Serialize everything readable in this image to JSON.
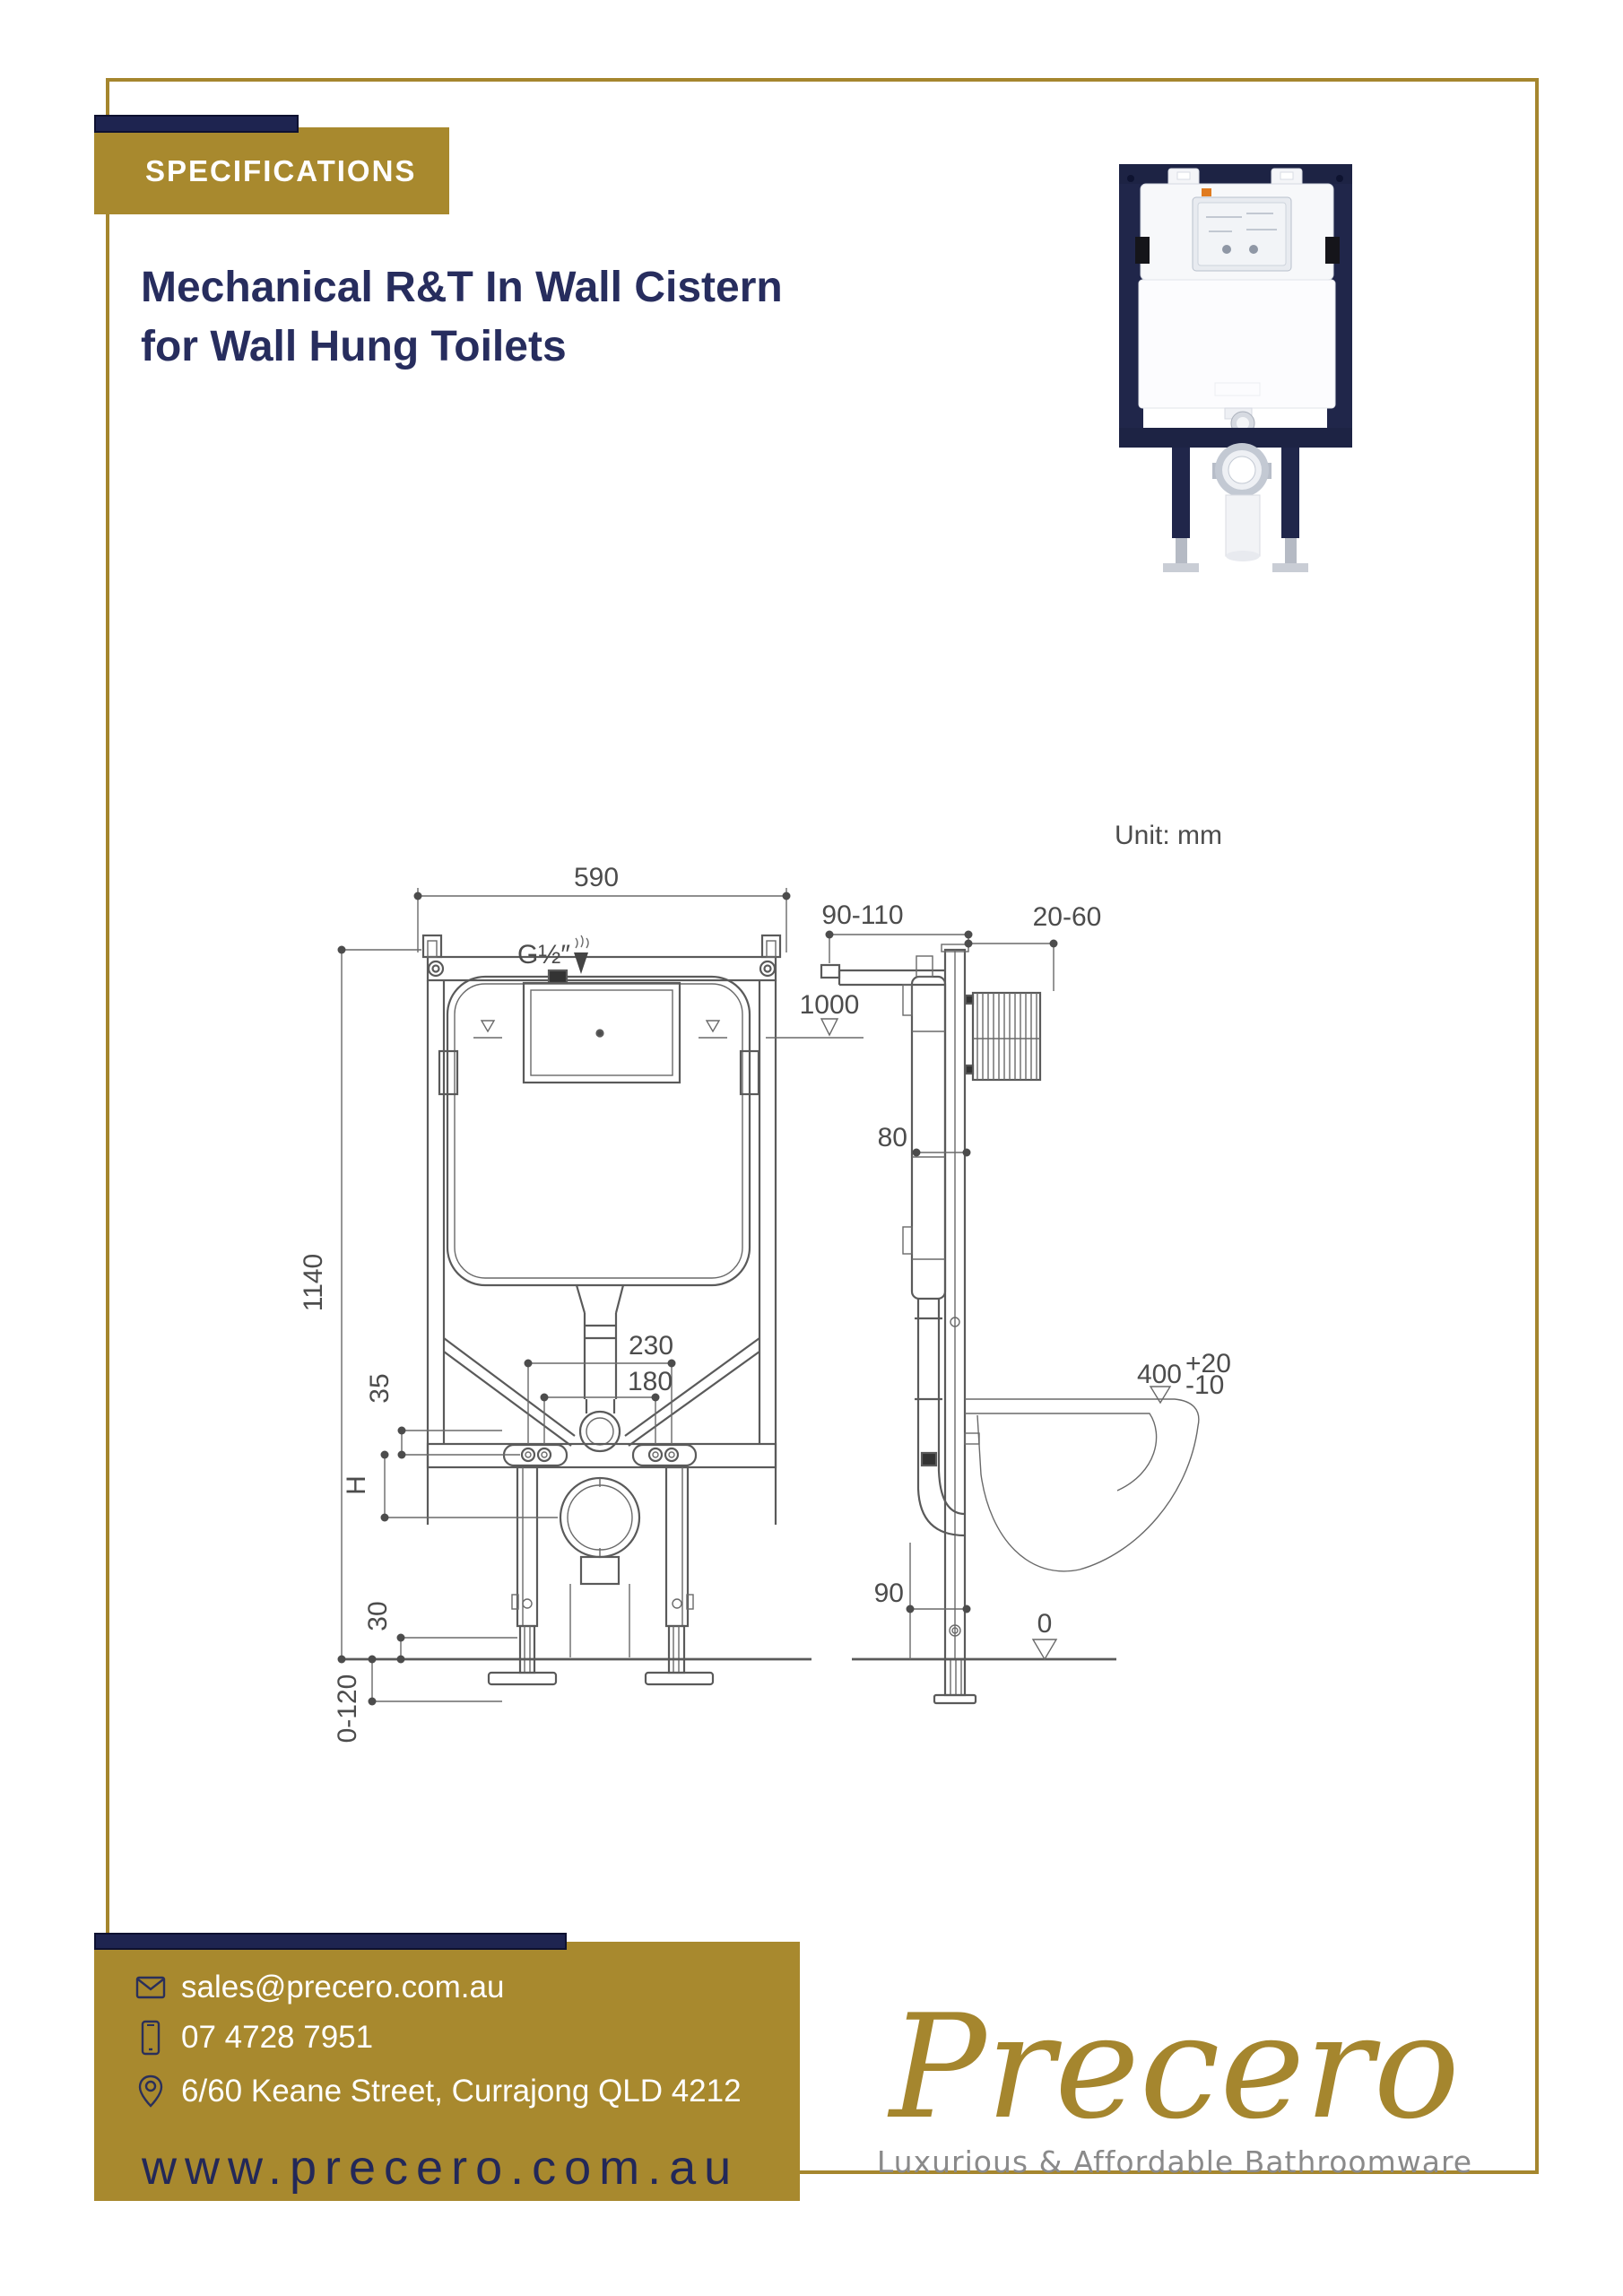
{
  "header": {
    "badge": "SPECIFICATIONS",
    "title_line1": "Mechanical R&T In Wall Cistern",
    "title_line2": "for Wall Hung Toilets"
  },
  "diagram": {
    "unit": "Unit: mm",
    "dims": {
      "top_width": "590",
      "inlet_thread": "G½″",
      "top_offset": "90-110",
      "panel_depth": "20-60",
      "button_height": "1000",
      "cistern_depth": "80",
      "frame_height": "1140",
      "bolt_spacing_outer": "230",
      "bolt_spacing_inner": "180",
      "rail_offset": "35",
      "outlet_drop": "H",
      "pan_height": "400",
      "pan_tol_plus": "+20",
      "pan_tol_minus": "-10",
      "outlet_height": "90",
      "bracket_height": "30",
      "floor_level": "0",
      "leg_adjust": "0-120"
    }
  },
  "footer": {
    "email": "sales@precero.com.au",
    "phone": "07 4728 7951",
    "address": "6/60 Keane Street, Currajong QLD 4212",
    "website": "www.precero.com.au",
    "logo": "Precero",
    "tagline": "Luxurious & Affordable Bathroomware",
    "icons": [
      "mail-icon",
      "phone-icon",
      "location-pin-icon"
    ]
  },
  "colors": {
    "gold": "#A8892E",
    "navy": "#1E2450",
    "title_navy": "#272D5E",
    "website_text": "#232858",
    "drawing_line": "#5A5A5A",
    "tagline_gray": "#8A8A8A"
  }
}
